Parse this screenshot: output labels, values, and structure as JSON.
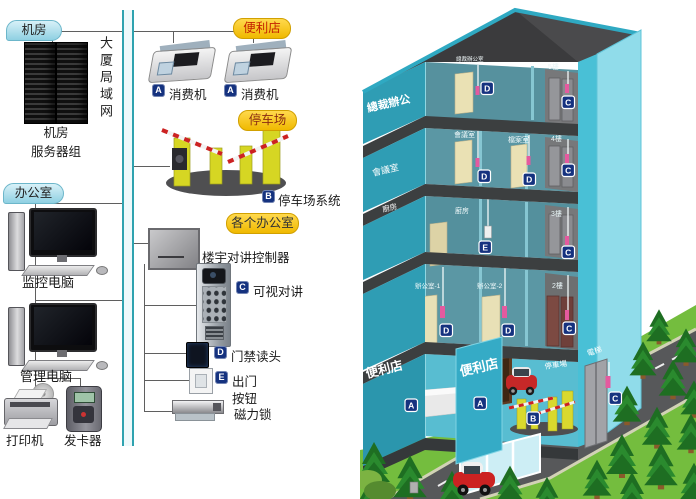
{
  "lan": {
    "label": "大厦局域网"
  },
  "server_room": {
    "badge": "机房",
    "caption1": "机房",
    "caption2": "服务器组"
  },
  "store": {
    "badge": "便利店",
    "m1_tag": "A",
    "m1_label": "消费机",
    "m2_tag": "A",
    "m2_label": "消费机"
  },
  "parking": {
    "badge": "停车场",
    "sys_tag": "B",
    "sys_label": "停车场系统"
  },
  "office": {
    "badge": "办公室",
    "monitor_pc": "监控电脑",
    "manage_pc": "管理电脑",
    "printer": "打印机",
    "card_issuer": "发卡器"
  },
  "each_office": {
    "badge": "各个办公室",
    "controller": "楼宇对讲控制器",
    "intercom_tag": "C",
    "intercom": "可视对讲",
    "reader_tag": "D",
    "reader": "门禁读头",
    "exit_tag": "E",
    "exit1": "出门",
    "exit2": "按钮",
    "lock": "磁力锁"
  },
  "building": {
    "f5": {
      "wall": "總裁辦公",
      "room": "總裁辦公室",
      "door_tag": "D",
      "floor": "5樓",
      "lift_tag": "C"
    },
    "f4": {
      "wall": "會議室",
      "room1": "會議室",
      "tag1": "D",
      "room2": "檔案室",
      "tag2": "D",
      "floor": "4樓",
      "lift_tag": "C"
    },
    "f3": {
      "wall": "廚房",
      "room": "廚房",
      "room_tag": "E",
      "floor": "3樓",
      "lift_tag": "C"
    },
    "f2": {
      "room1": "辦公室-1",
      "tag1": "D",
      "room2": "辦公室-2",
      "tag2": "D",
      "floor": "2樓",
      "lift_tag": "C"
    },
    "f1": {
      "wall": "便利店",
      "pillar": "便利店",
      "tag1": "A",
      "tag2": "A",
      "parking": "停車場",
      "parking_tag": "B",
      "lift": "電梯",
      "lift_tag": "C"
    }
  },
  "colors": {
    "badge_navy": "#15327f",
    "lan_teal": "#2fa3b0",
    "building_cyan": "#3fb9d2",
    "badge_yellow": "#f6c51f"
  }
}
